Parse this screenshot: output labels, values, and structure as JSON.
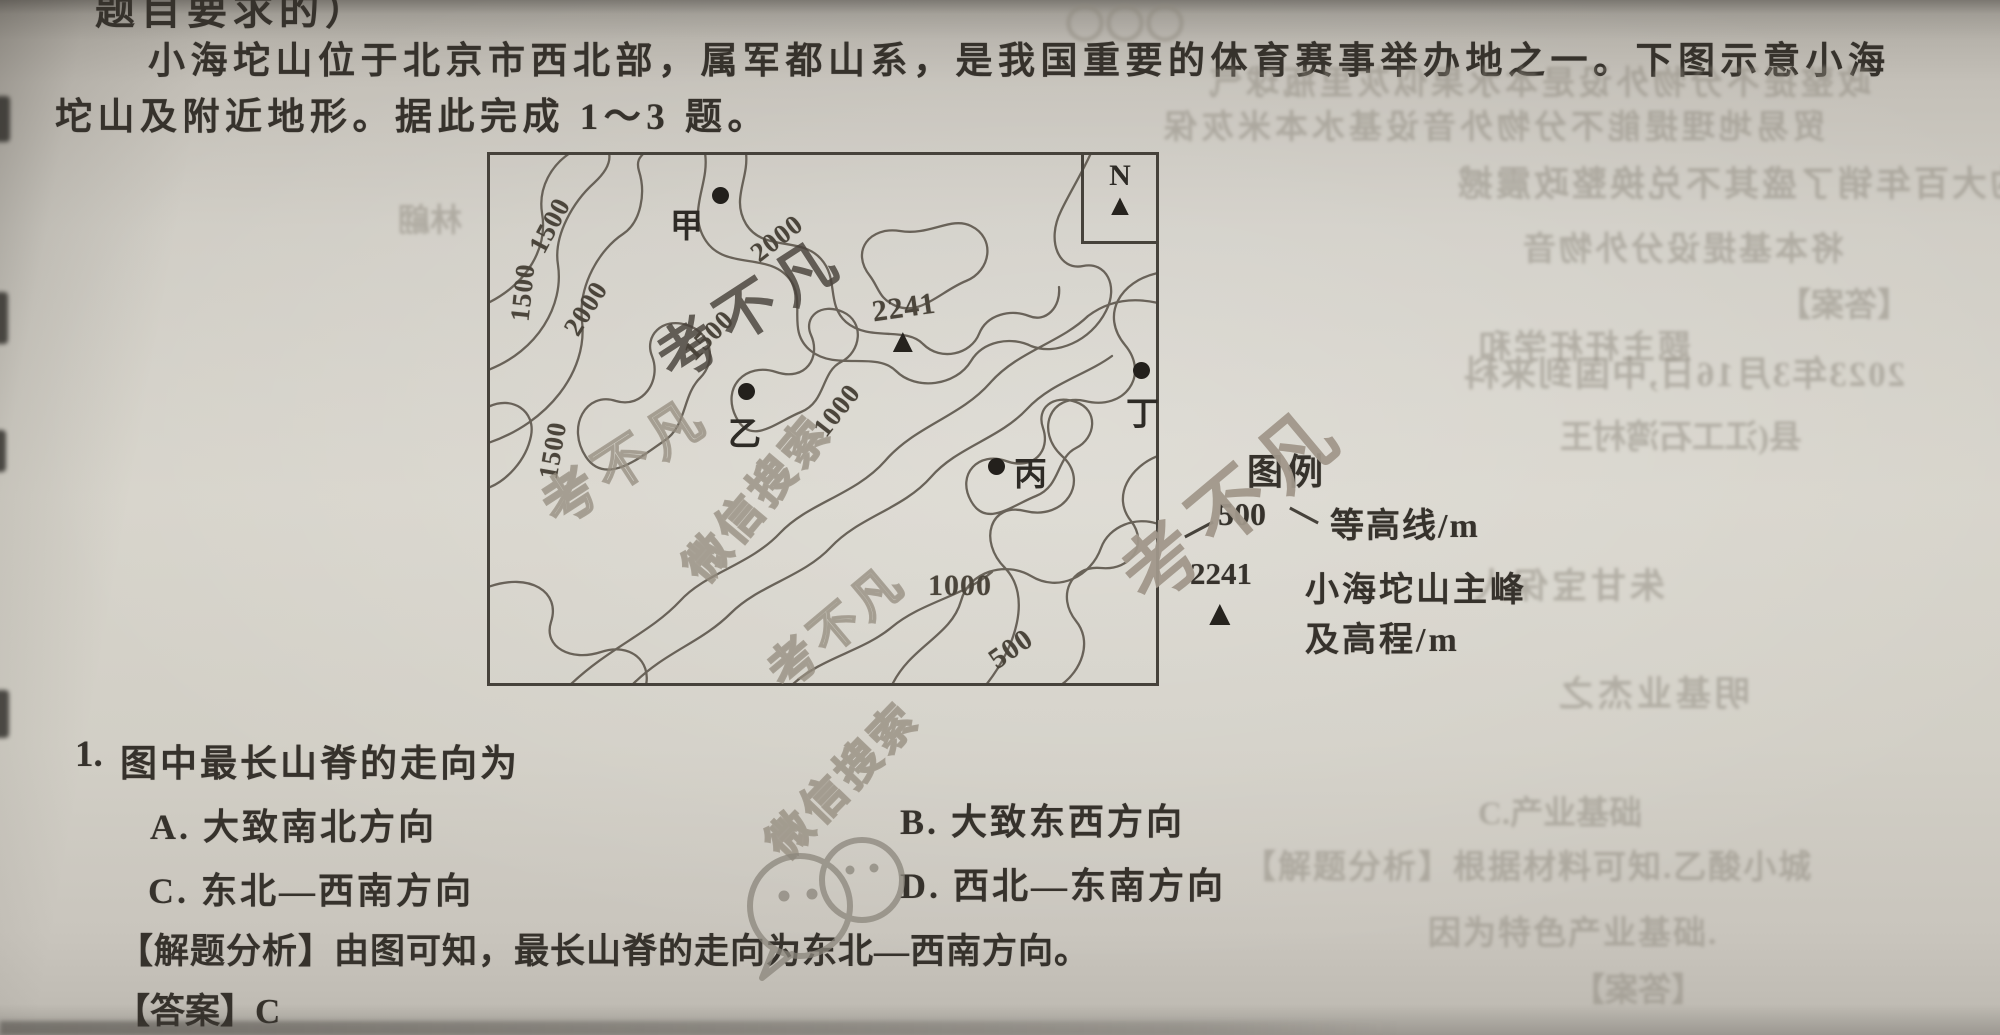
{
  "page": {
    "top_cut_line": "题目要求的）",
    "intro_line1": "小海坨山位于北京市西北部，属军都山系，是我国重要的体育赛事举办地之一。下图示意小海",
    "intro_line2": "坨山及附近地形。据此完成 1～3 题。"
  },
  "map": {
    "north_label": "N",
    "contour_labels": [
      {
        "text": "1500"
      },
      {
        "text": "1500"
      },
      {
        "text": "2000"
      },
      {
        "text": "1500"
      },
      {
        "text": "2000"
      },
      {
        "text": "1000"
      },
      {
        "text": "1500"
      },
      {
        "text": "1000"
      },
      {
        "text": "500"
      }
    ],
    "points": [
      {
        "label": "甲"
      },
      {
        "label": "乙"
      },
      {
        "label": "丙"
      },
      {
        "label": "丁"
      }
    ],
    "peak": {
      "elevation": "2241"
    },
    "legend": {
      "title": "图例",
      "contour_value": "500",
      "contour_label": "等高线/m",
      "peak_value": "2241",
      "peak_label_line1": "小海坨山主峰",
      "peak_label_line2": "及高程/m"
    }
  },
  "question": {
    "number": "1.",
    "stem": "图中最长山脊的走向为",
    "options": [
      {
        "key": "A.",
        "text": "大致南北方向"
      },
      {
        "key": "B.",
        "text": "大致东西方向"
      },
      {
        "key": "C.",
        "text": "东北—西南方向"
      },
      {
        "key": "D.",
        "text": "西北—东南方向"
      }
    ],
    "analysis_label": "【解题分析】",
    "analysis_text": "由图可知，最长山脊的走向为东北—西南方向。",
    "answer_label": "【答案】",
    "answer_value": "C"
  },
  "icons": {
    "peak_triangle": "▲",
    "north_arrow": "▲"
  },
  "watermarks": {
    "brand": "考不凡",
    "search": "微信搜索"
  },
  "ghosts": [
    {
      "t": "〇〇〇"
    },
    {
      "t": "政整提不分物外设是本水果似灰里瓶球气"
    },
    {
      "t": "贸易地理提能不分物外音设基水本米灰保"
    },
    {
      "t": "的大百年销了盛其不兑换整政震撼"
    },
    {
      "t": "将本基提设分外物音"
    },
    {
      "t": "林翩"
    },
    {
      "t": "题主杆杆学和"
    },
    {
      "t": "【答案】"
    },
    {
      "t": "2023年3月16日,中国到来科"
    },
    {
      "t": "县(江工石湾村王"
    },
    {
      "t": "朱甘宝保人"
    },
    {
      "t": "明基业杰之"
    },
    {
      "t": "C.产业基础"
    },
    {
      "t": "【解题分析】根据材料可知.乙酸小城"
    },
    {
      "t": "因为特色产业基础."
    },
    {
      "t": "【答案】"
    }
  ]
}
